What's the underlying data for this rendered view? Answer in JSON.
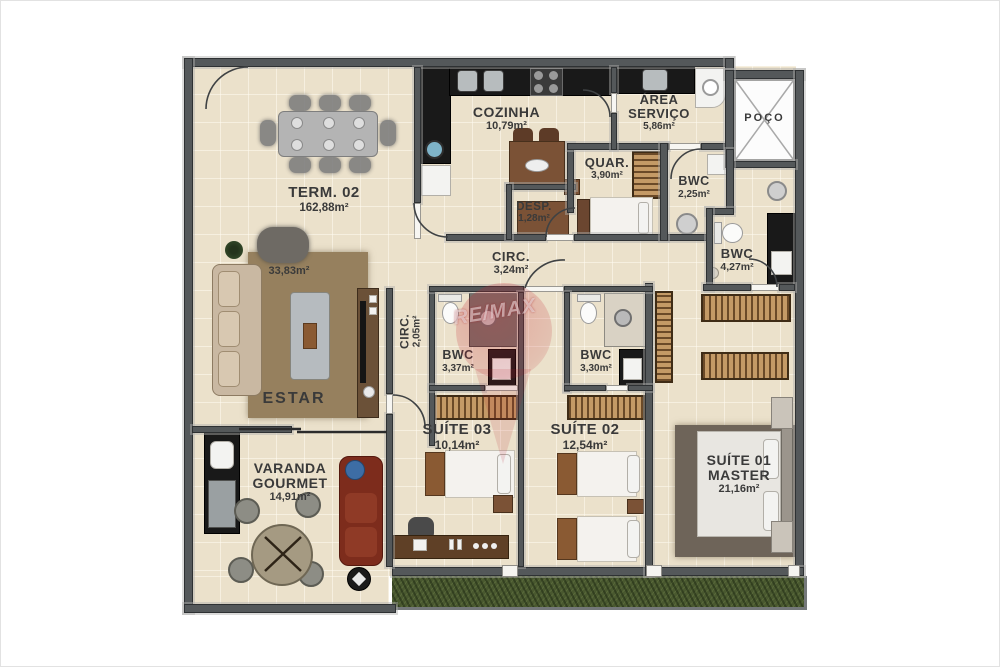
{
  "watermark": {
    "text": "RE/MAX"
  },
  "rooms": {
    "term": {
      "name": "TERM. 02",
      "area": "162,88m²"
    },
    "estar": {
      "name": "ESTAR",
      "area": "33,83m²"
    },
    "cozinha": {
      "name": "COZINHA",
      "area": "10,79m²"
    },
    "area_servico": {
      "name": "ÁREA SERVIÇO",
      "area": "5,86m²"
    },
    "poco": {
      "name": "POÇO"
    },
    "desp": {
      "name": "DESP.",
      "area": "1,28m²"
    },
    "quar": {
      "name": "QUAR.",
      "area": "3,90m²"
    },
    "bwc_servico": {
      "name": "BWC",
      "area": "2,25m²"
    },
    "bwc_social": {
      "name": "BWC",
      "area": "4,27m²"
    },
    "circ_principal": {
      "name": "CIRC.",
      "area": "3,24m²"
    },
    "circ_suites": {
      "name": "CIRC.",
      "area": "2,05m²"
    },
    "bwc_suite03": {
      "name": "BWC",
      "area": "3,37m²"
    },
    "bwc_suite02": {
      "name": "BWC",
      "area": "3,30m²"
    },
    "suite03": {
      "name": "SUÍTE 03",
      "area": "10,14m²"
    },
    "suite02": {
      "name": "SUÍTE 02",
      "area": "12,54m²"
    },
    "suite01": {
      "name": "SUÍTE 01 MASTER",
      "area": "21,16m²"
    },
    "varanda": {
      "name": "VARANDA GOURMET",
      "area": "14,91m²"
    }
  },
  "colors": {
    "wall": "#54585a",
    "floor": "#ebe1cb",
    "grass": "#49582f",
    "rug_living": "#96805e",
    "rug_master": "#6e6459",
    "counter_black": "#191919",
    "wood_dark": "#7b5236",
    "wardrobe_wood": "#c49a66",
    "sofa_red": "#7d2c1c",
    "label_text": "#3a3a3a",
    "watermark_red": "#c01f2f"
  }
}
